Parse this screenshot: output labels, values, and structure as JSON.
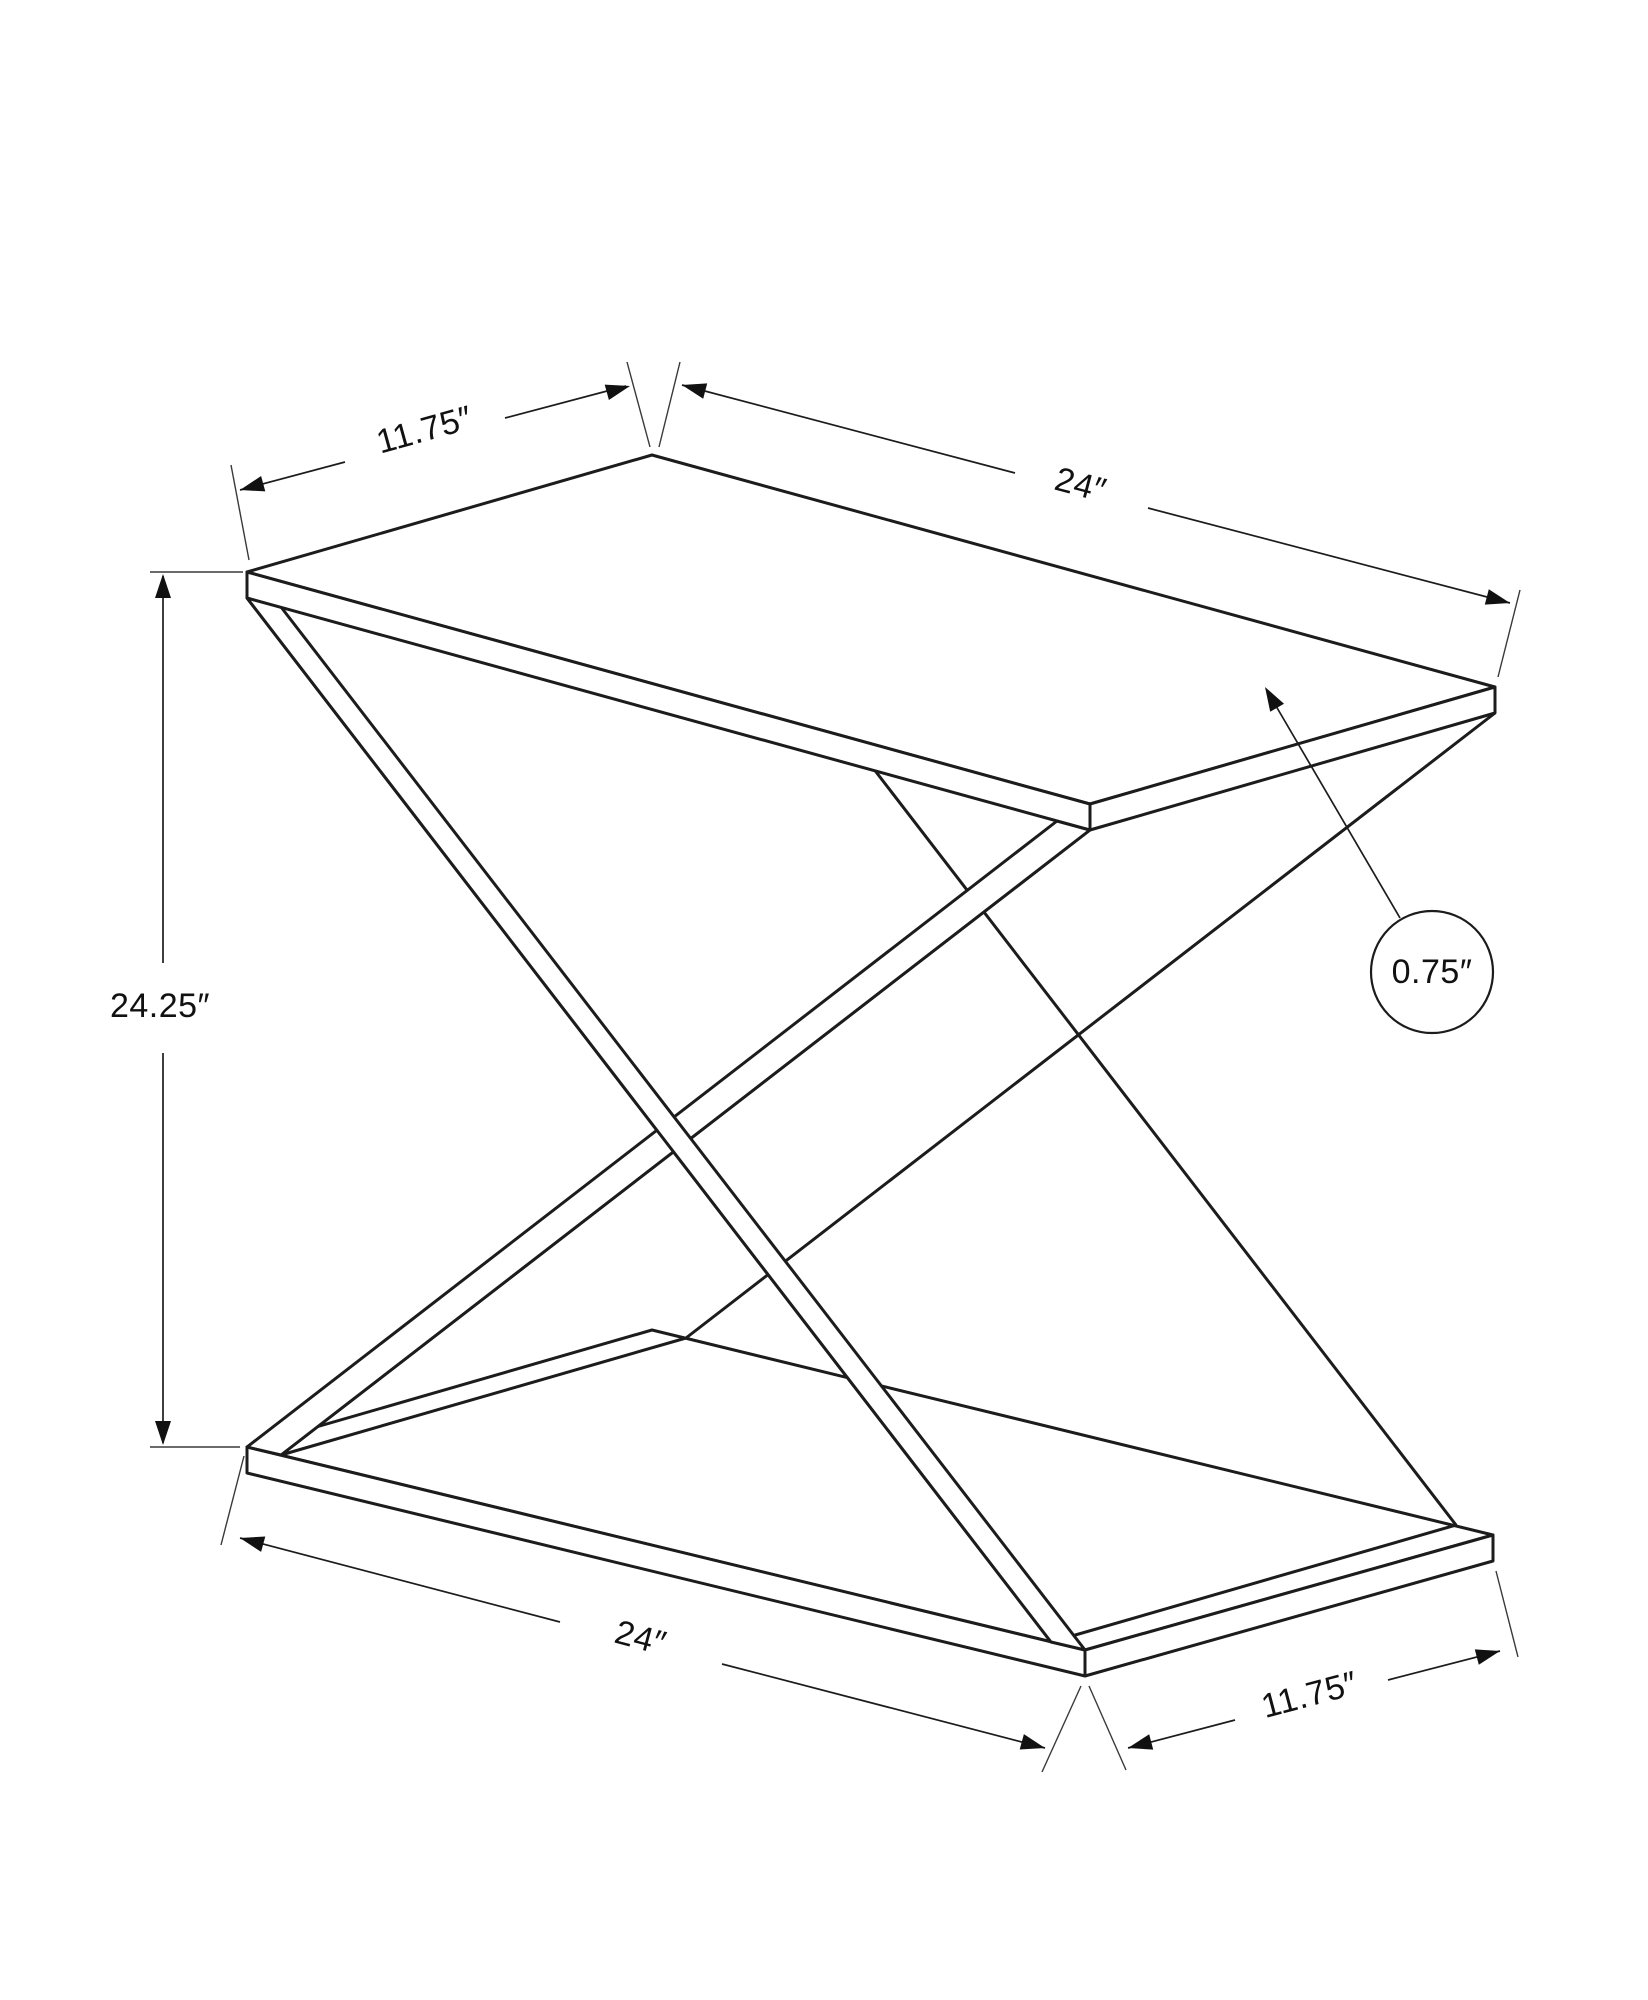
{
  "figure": {
    "type": "isometric-dimension-diagram",
    "subject": "X-frame accent table line drawing",
    "background_color": "#ffffff",
    "line_color": "#1c1c1c"
  },
  "dimensions": {
    "top_depth": {
      "label": "11.75″",
      "value": 11.75,
      "unit": "in"
    },
    "top_width": {
      "label": "24″",
      "value": 24,
      "unit": "in"
    },
    "height": {
      "label": "24.25″",
      "value": 24.25,
      "unit": "in"
    },
    "thickness": {
      "label": "0.75″",
      "value": 0.75,
      "unit": "in"
    },
    "base_width": {
      "label": "24″",
      "value": 24,
      "unit": "in"
    },
    "base_depth": {
      "label": "11.75″",
      "value": 11.75,
      "unit": "in"
    }
  }
}
